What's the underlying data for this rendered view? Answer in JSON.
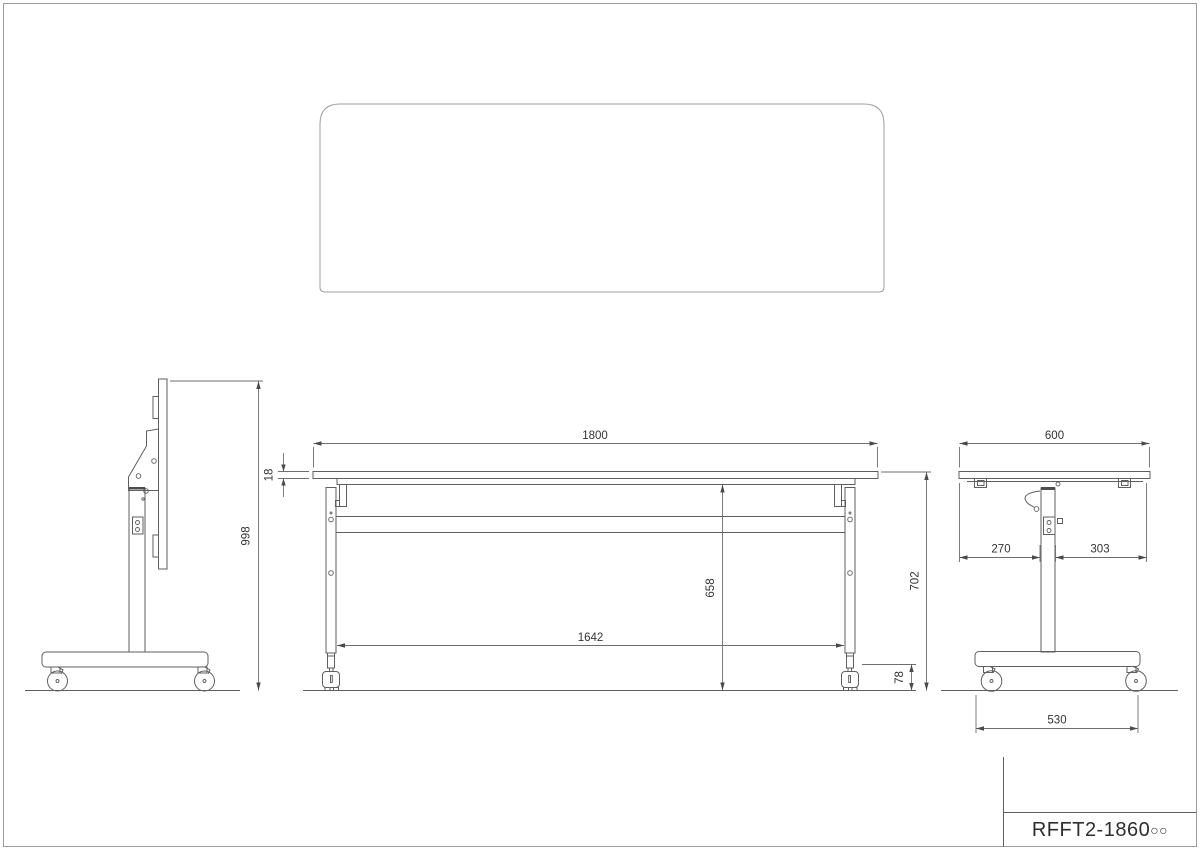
{
  "sheet": {
    "product_code": "RFFT2-1860",
    "variant_suffix": "○○"
  },
  "dimensions": {
    "front_width": "1800",
    "top_thickness": "18",
    "underside_height": "658",
    "leg_inner_span": "1642",
    "floor_to_top_underside": "702",
    "caster_height": "78",
    "folded_height": "998",
    "depth": "600",
    "depth_front_segment": "270",
    "depth_rear_segment": "303",
    "base_caster_span": "530"
  },
  "colors": {
    "line": "#5f5f5f",
    "light_line": "#9c9c9c",
    "dimension_line": "#6e6e6e",
    "text": "#333333",
    "background": "#ffffff"
  }
}
